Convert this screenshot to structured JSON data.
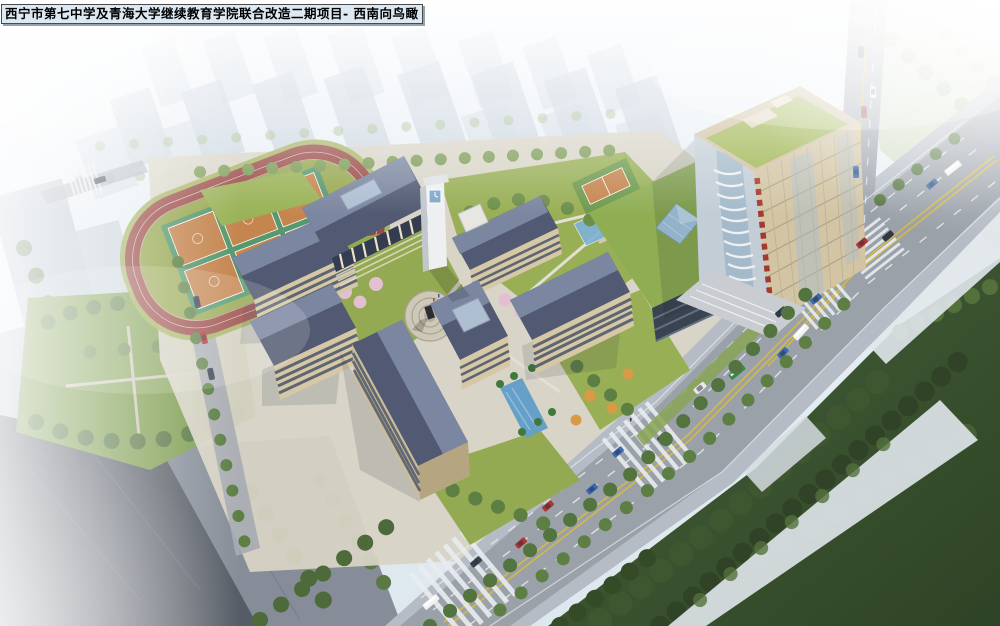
{
  "caption": {
    "text": "西宁市第七中学及青海大学继续教育学院联合改造二期项目- 西南向鸟瞰",
    "project_name": "西宁市第七中学及青海大学继续教育学院联合改造二期项目",
    "view_label": "西南向鸟瞰"
  },
  "scene": {
    "type": "architectural-aerial-rendering",
    "regions": [
      "running-track-sports-field",
      "basketball-courts",
      "school-courtyard-buildings",
      "main-hall-with-colonnade",
      "clock-tower",
      "central-plaza-monument",
      "highrise-tower-green-roof",
      "rooftop-sports-court",
      "glass-pyramid-skylight",
      "water-canal-entrance",
      "main-avenue",
      "vertical-street",
      "intersection",
      "crosswalks",
      "street-trees",
      "dense-tree-park-southeast",
      "park-lawn-southwest",
      "hazy-city-background"
    ]
  },
  "palette": {
    "sky_haze": "#e9f0f5",
    "haze_building": "#c7d3de",
    "track_red": "#9a4b47",
    "infield_green": "#97a851",
    "court_orange": "#c5854f",
    "court_lane_green": "#57986e",
    "roof_slate_dark": "#515a72",
    "roof_slate_light": "#7b86a0",
    "wall_beige": "#d6c8a6",
    "wall_shadow": "#a89878",
    "window_dark": "#4a5568",
    "lawn_green": "#95ab53",
    "tree_green": "#6d8f4a",
    "park_tree_dark": "#3f5731",
    "blossom_pink": "#e3bfd2",
    "autumn_orange": "#d79a45",
    "asphalt": "#9aa1a9",
    "sidewalk": "#b6bcc5",
    "marking_yellow": "#d9ba3e",
    "marking_white": "#e9edf0",
    "tower_wall": "#d3c5a4",
    "tower_roof_green": "#9fb653",
    "tower_accent_red": "#a23a30",
    "glass_blue": "#a8cce8",
    "water_blue": "#66a0c8",
    "clock_tower_white": "#edeff1",
    "caption_bg": "#dce8f2",
    "caption_border": "#4a4a4a"
  },
  "traffic": {
    "vehicle_colors": [
      "#b03434",
      "#3a6ab0",
      "#39424e",
      "#e8e8e8"
    ],
    "bus_colors": [
      "#f2f2f2",
      "#3a8a4a"
    ]
  }
}
